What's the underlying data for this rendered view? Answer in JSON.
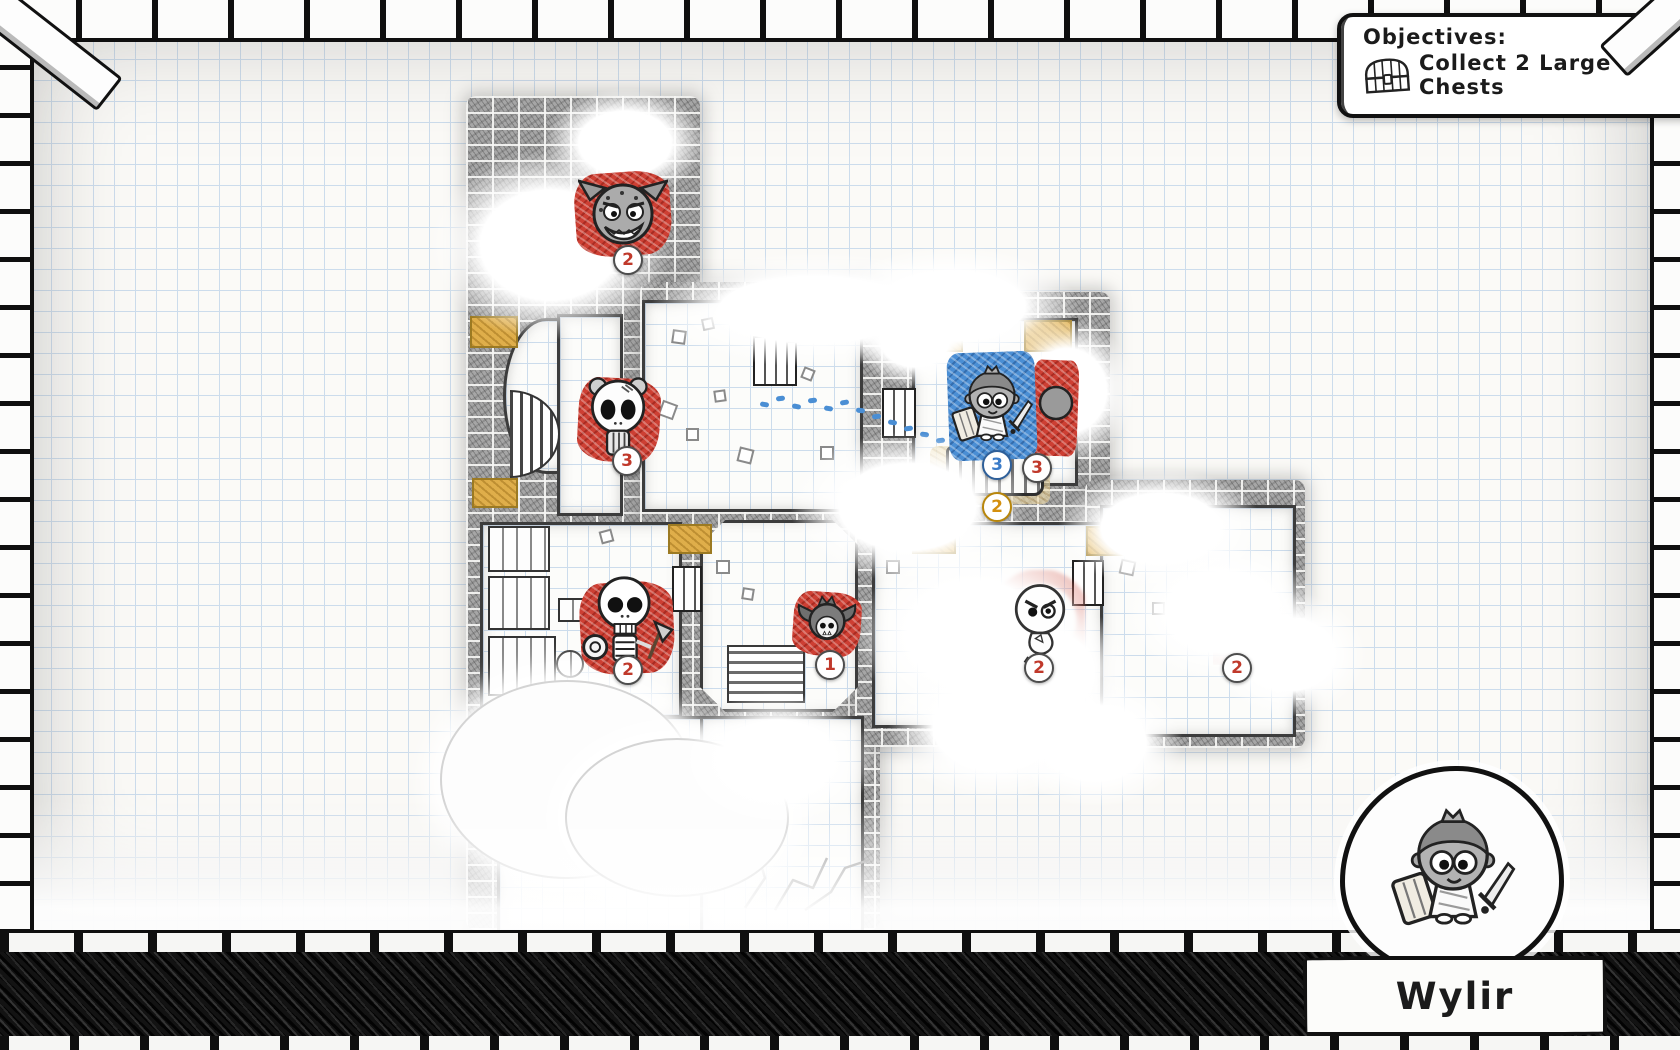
{
  "objectives": {
    "title": "Objectives:",
    "items": [
      {
        "icon": "chest-icon",
        "label": "Collect 2 Large Chests"
      }
    ]
  },
  "hero": {
    "name": "Wylir"
  },
  "map": {
    "tokens": [
      {
        "id": "gremlin",
        "team": "enemy",
        "badges": [
          {
            "value": "2",
            "color": "red"
          }
        ]
      },
      {
        "id": "skull-bear",
        "team": "enemy",
        "badges": [
          {
            "value": "3",
            "color": "red"
          }
        ]
      },
      {
        "id": "skeleton",
        "team": "enemy",
        "badges": [
          {
            "value": "2",
            "color": "red"
          }
        ]
      },
      {
        "id": "bat",
        "team": "enemy",
        "badges": [
          {
            "value": "1",
            "color": "red"
          }
        ]
      },
      {
        "id": "wylir-player",
        "team": "player",
        "badges": [
          {
            "value": "3",
            "color": "blue"
          },
          {
            "value": "3",
            "color": "red"
          },
          {
            "value": "2",
            "color": "gold"
          }
        ]
      },
      {
        "id": "angry-chick",
        "team": "enemy",
        "badges": [
          {
            "value": "2",
            "color": "red"
          }
        ]
      },
      {
        "id": "fogged-enemy",
        "team": "enemy",
        "badges": [
          {
            "value": "2",
            "color": "red"
          }
        ]
      }
    ]
  },
  "colors": {
    "enemy_red": "#cd3f33",
    "player_blue": "#4a8ed4",
    "gold": "#dfae4a",
    "badge_red": "#c0392b",
    "badge_blue": "#3a7bc8",
    "badge_gold": "#d4900f",
    "paper": "#fbfaf7",
    "grid_blue": "#ccdcec",
    "ink": "#1b1b1b"
  }
}
